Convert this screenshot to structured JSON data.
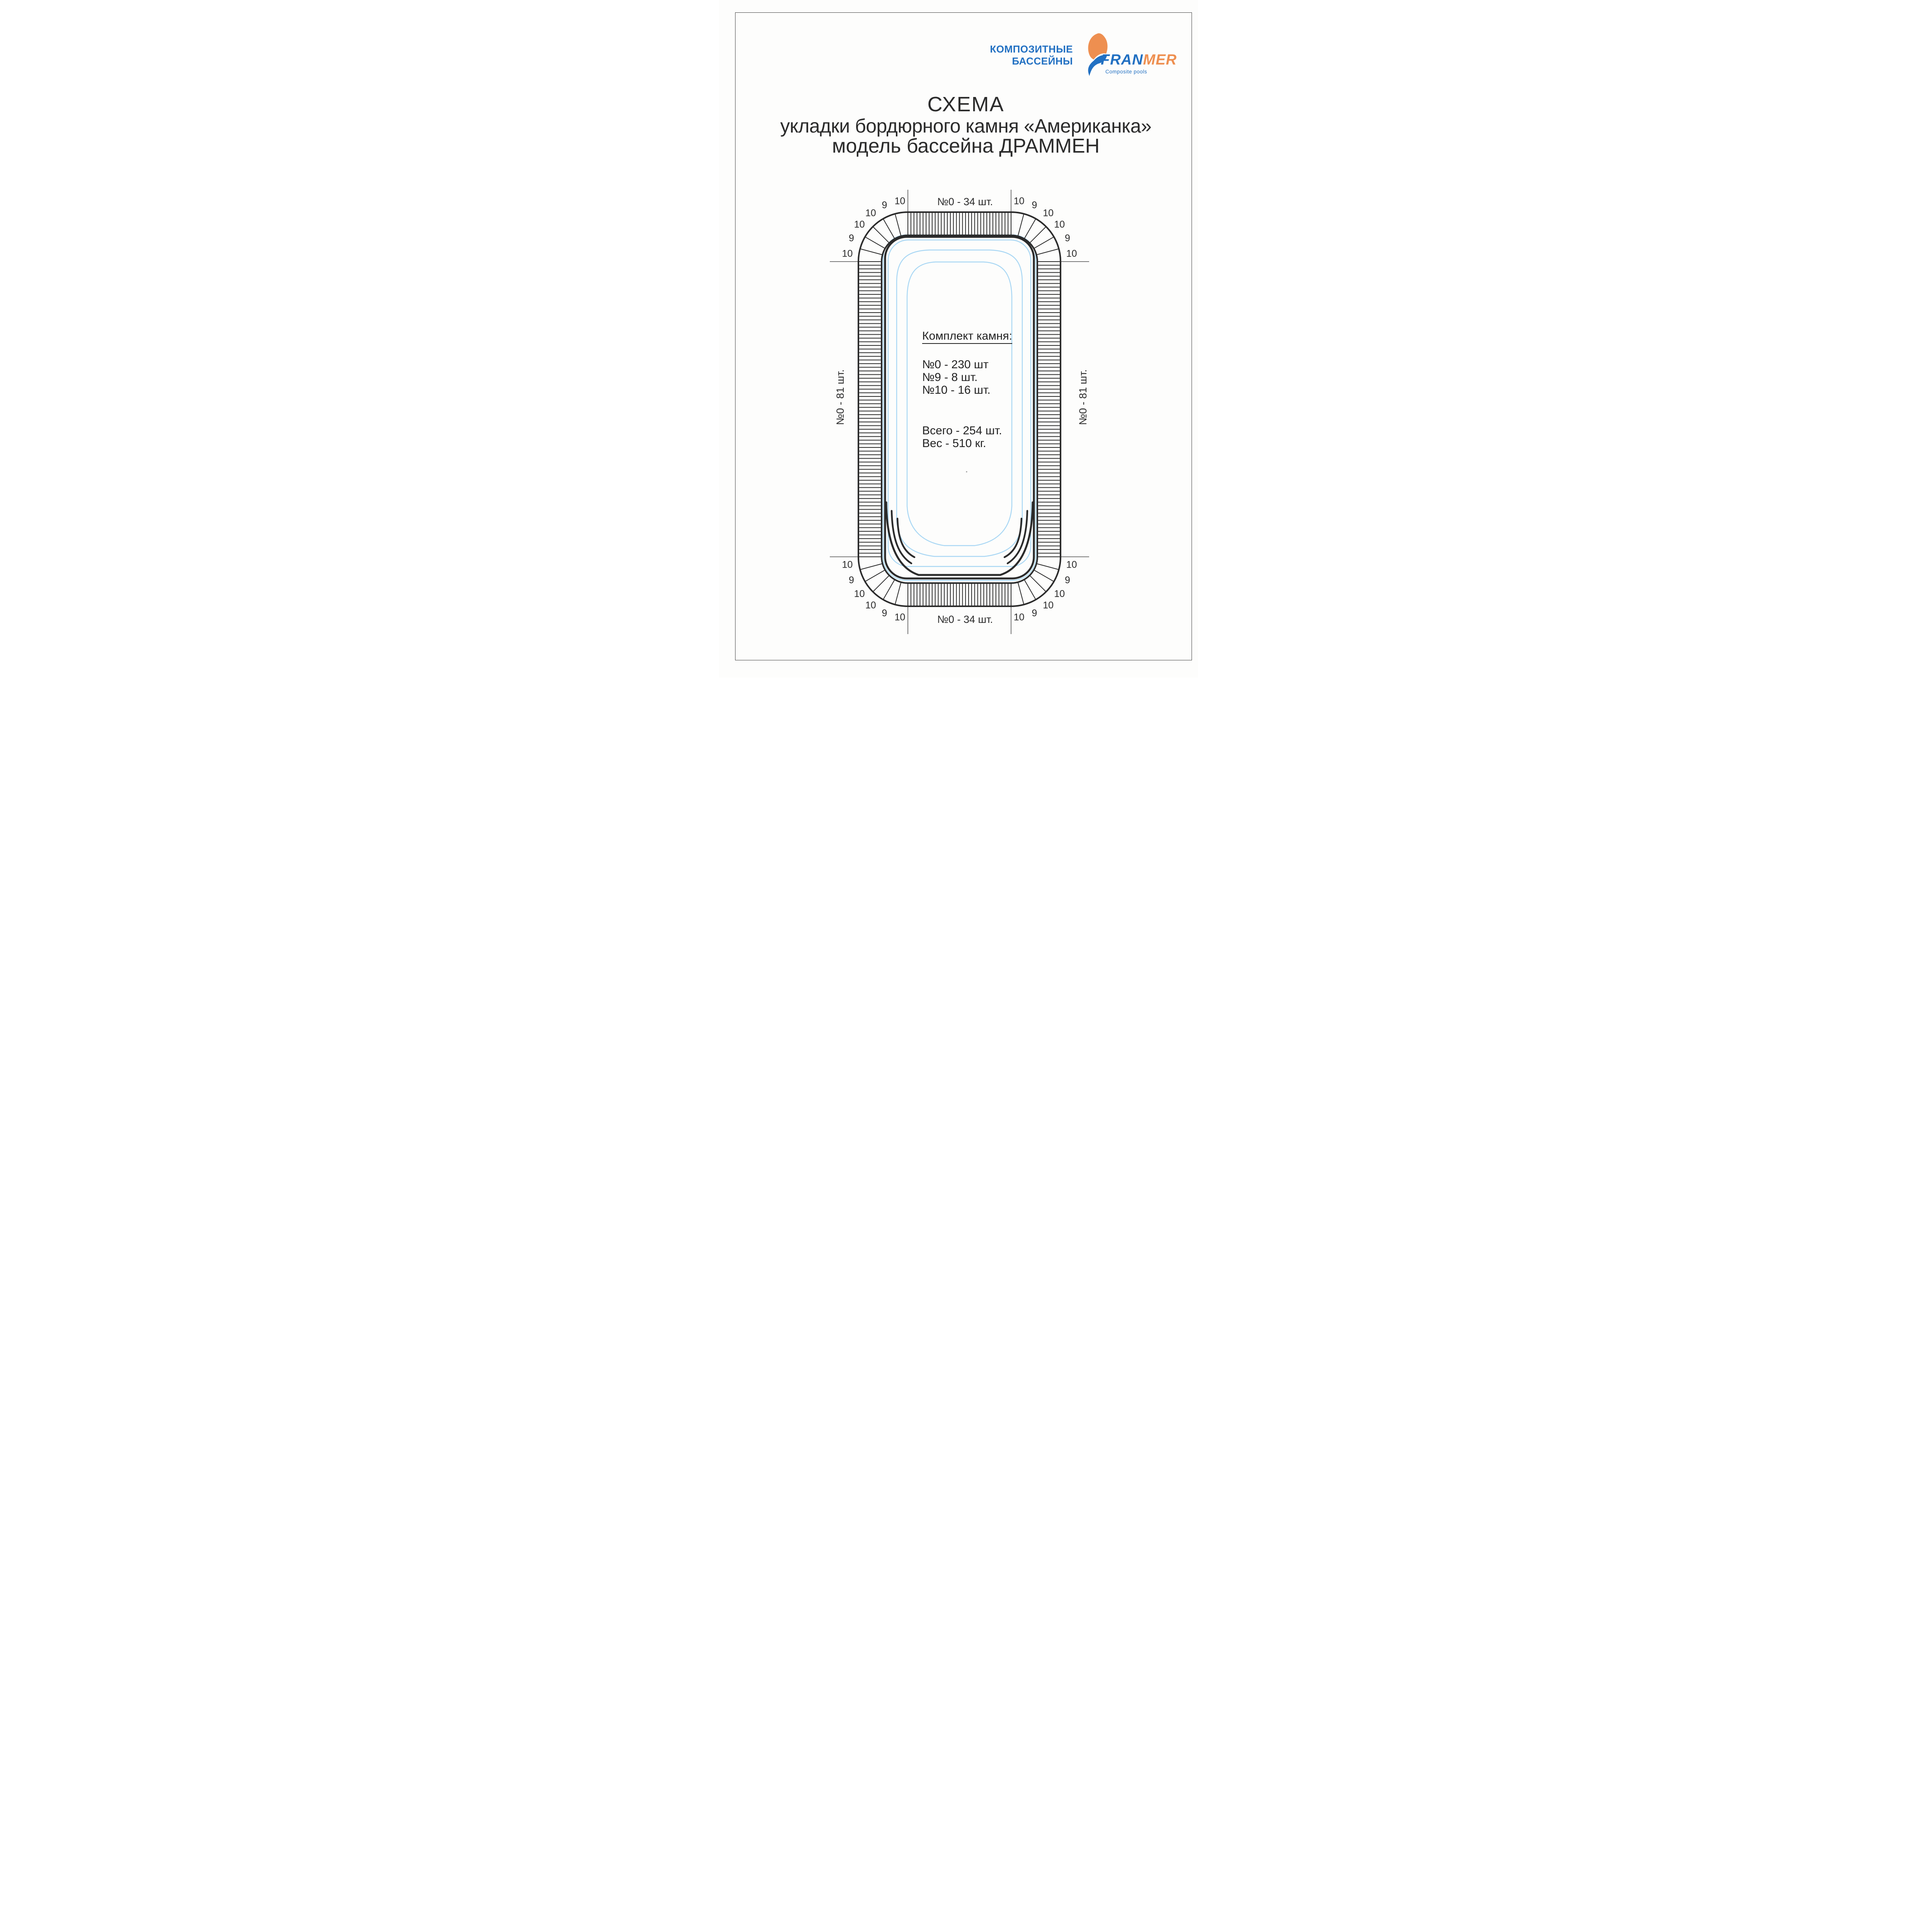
{
  "logo": {
    "line1": "КОМПОЗИТНЫЕ",
    "line2": "БАССЕЙНЫ",
    "brand_blue": "FRAN",
    "brand_orange": "MER",
    "tagline": "Composite pools",
    "colors": {
      "blue": "#2170c2",
      "orange": "#ee8f50"
    }
  },
  "title": {
    "line1": "СХЕМА",
    "line2": "укладки бордюрного камня «Американка»",
    "line3": "модель бассейна ДРАММЕН"
  },
  "diagram": {
    "labels": {
      "top": "№0 - 34 шт.",
      "bottom": "№0 - 34 шт.",
      "left": "№0 - 81 шт.",
      "right": "№0 - 81 шт."
    },
    "corner_numbers": [
      "10",
      "9",
      "10",
      "10",
      "9",
      "10"
    ],
    "stone_counts": {
      "top_edge": 34,
      "bottom_edge": 34,
      "left_edge": 81,
      "right_edge": 81,
      "corner_stones_per_corner": 6
    },
    "kit": {
      "heading": "Комплект камня:",
      "items": [
        "№0 - 230 шт",
        "№9 - 8 шт.",
        "№10 - 16 шт."
      ],
      "total": "Всего - 254 шт.",
      "weight": "Вес - 510 кг."
    },
    "colors": {
      "ink": "#2b2b2b",
      "pool_blue": "#a9d7f4"
    }
  }
}
